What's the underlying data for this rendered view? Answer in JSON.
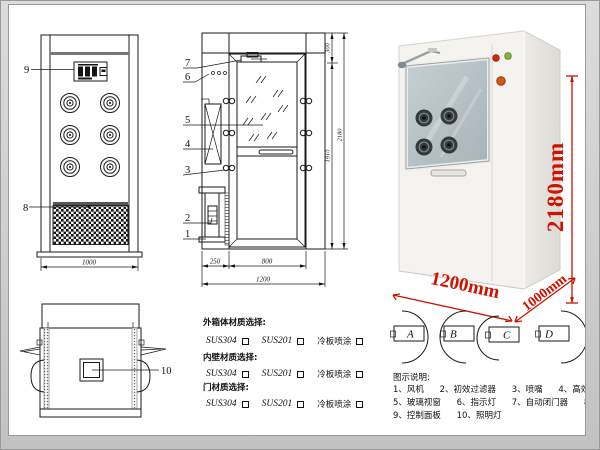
{
  "front_view": {
    "label_control_panel": "9",
    "label_grille": "8",
    "dim_width": "1000"
  },
  "side_view": {
    "label_7": "7",
    "label_6": "6",
    "label_5": "5",
    "label_4": "4",
    "label_3": "3",
    "label_2": "2",
    "label_1": "1",
    "dim_top": "300",
    "dim_door_height": "1910",
    "dim_total_height": "2180",
    "dim_left": "250",
    "dim_door_width": "800",
    "dim_total_width": "1200"
  },
  "photo": {
    "dim_height": "2180mm",
    "dim_width": "1200mm",
    "dim_depth": "1000mm"
  },
  "top_view": {
    "label_lamp": "10"
  },
  "materials": {
    "groups": [
      {
        "title": "外箱体材质选择:",
        "options": [
          "SUS304",
          "SUS201",
          "冷板喷涂"
        ]
      },
      {
        "title": "内壁材质选择:",
        "options": [
          "SUS304",
          "SUS201",
          "冷板喷涂"
        ]
      },
      {
        "title": "门材质选择:",
        "options": [
          "SUS304",
          "SUS201",
          "冷板喷涂"
        ]
      }
    ]
  },
  "door_options": [
    "A",
    "B",
    "C",
    "D"
  ],
  "legend": {
    "title": "图示说明:",
    "items": [
      "1、风机",
      "2、初效过滤器",
      "3、喷嘴",
      "4、高效过滤器",
      "5、玻璃视窗",
      "6、指示灯",
      "7、自动闭门器",
      "8、红外线感应器",
      "9、控制面板",
      "10、照明灯"
    ]
  },
  "colors": {
    "annotation_red": "#cf1100",
    "indicator_red": "#d32b10",
    "indicator_green": "#84b63f",
    "button_orange": "#cd5a1c"
  }
}
